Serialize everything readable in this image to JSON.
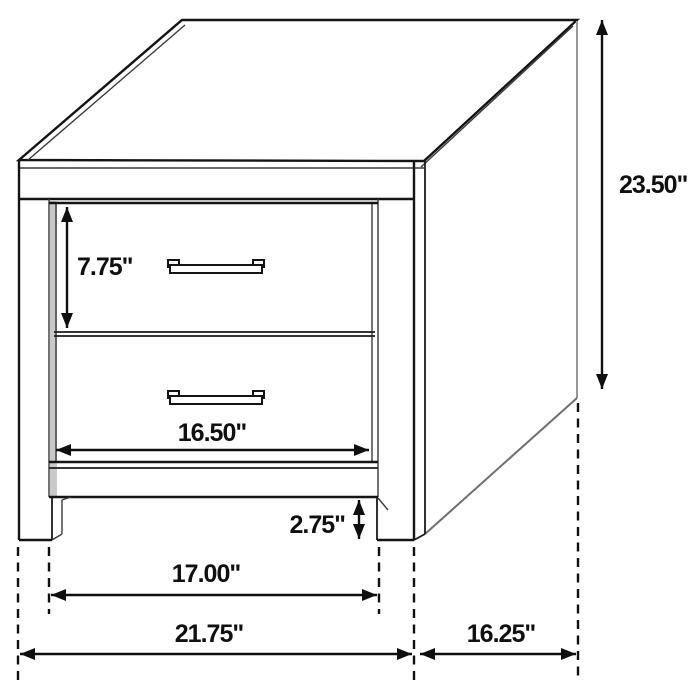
{
  "diagram": {
    "type": "furniture-dimension-diagram",
    "subject": "two-drawer nightstand line drawing",
    "labels": {
      "drawer_front_height": "7.75\"",
      "overall_height": "23.50\"",
      "drawer_opening_width": "16.50\"",
      "base_clearance": "2.75\"",
      "leg_inner_span": "17.00\"",
      "overall_width": "21.75\"",
      "side_depth": "16.25\""
    },
    "colors": {
      "line": "#141414",
      "background": "#ffffff",
      "side_edge_gray": "#979797"
    }
  }
}
